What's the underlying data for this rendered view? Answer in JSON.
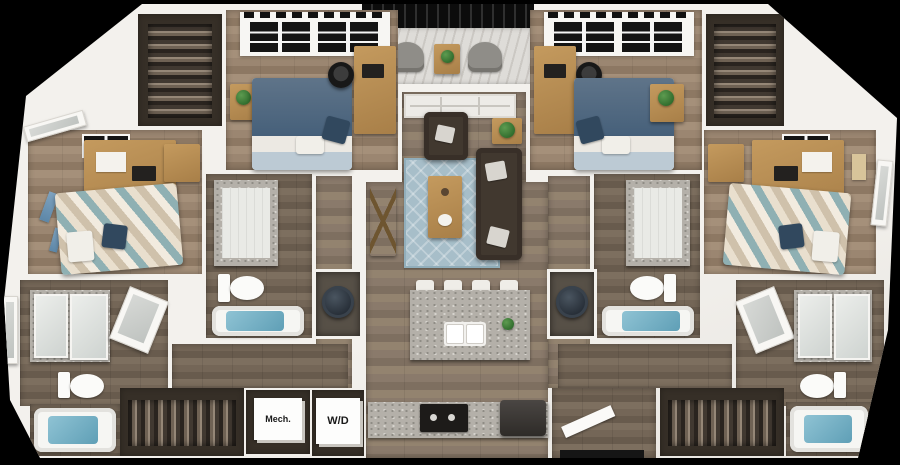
{
  "labels": {
    "mech": "Mech.",
    "wd": "W/D"
  },
  "colors": {
    "background": "#000000",
    "wall": "#f3f1ed",
    "wood_living": "#8a7a6b",
    "wood_bedroom": "#9b8671",
    "wood_furniture": "#c49a5e",
    "wood_furniture_dark": "#a87f48",
    "rug": "#a7bec9",
    "sofa": "#41382f",
    "cushion": "#d8d5cf",
    "bed_blue": "#5f7489",
    "bed_blue_dark": "#46607a",
    "sheet": "#ece9e3",
    "chevron_teal": "#8fb0b3",
    "chevron_cream": "#e9dfce",
    "pillow_navy": "#31485e",
    "granite": "#b4b0a9",
    "water": "#5f9fb6",
    "porcelain": "#fbfbf9",
    "closet_dark": "#362f27",
    "appliance_dark": "#2e2b28",
    "plant": "#2f6b2c",
    "chair_black": "#181818"
  }
}
